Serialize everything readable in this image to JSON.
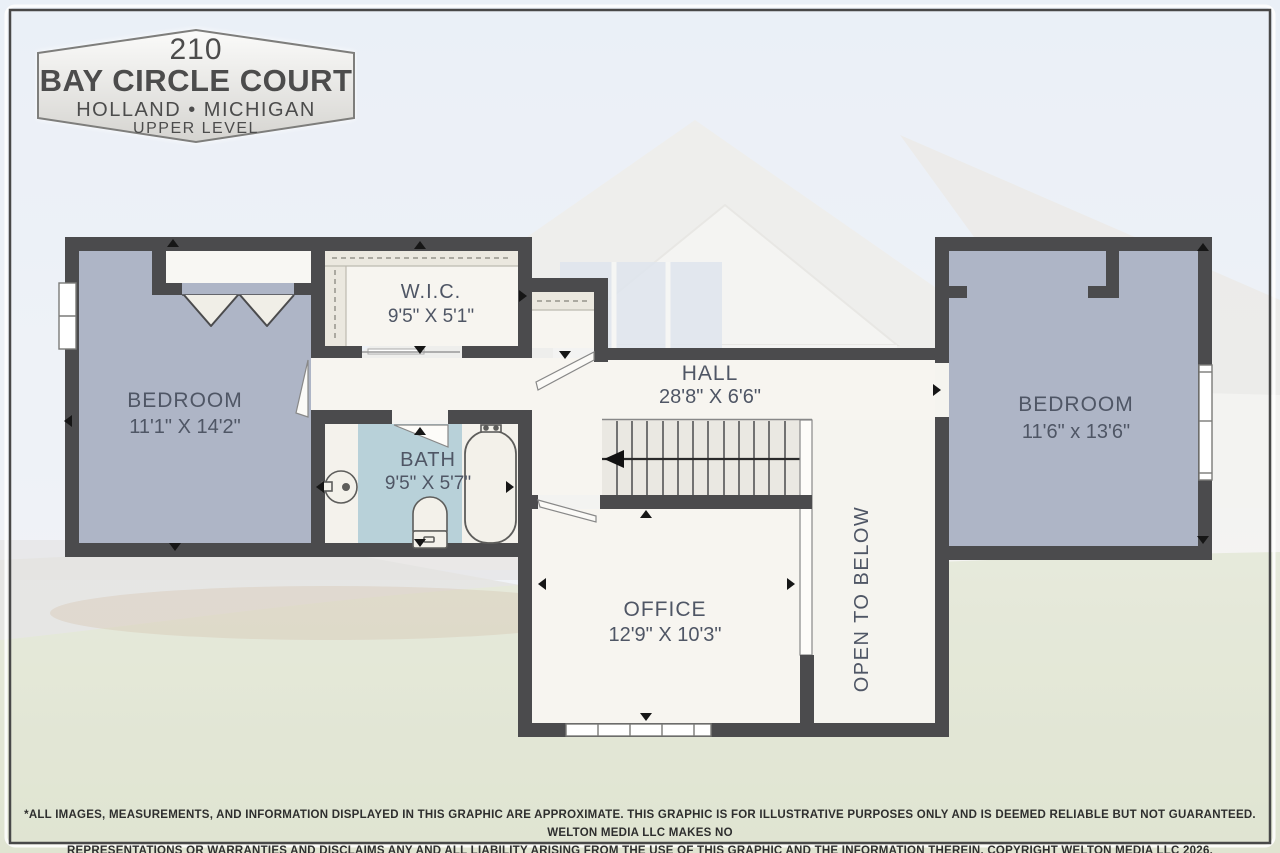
{
  "badge": {
    "address_number": "210",
    "street": "BAY CIRCLE COURT",
    "city_state": "HOLLAND • MICHIGAN",
    "level": "UPPER LEVEL"
  },
  "rooms": {
    "bedroom_left": {
      "name": "BEDROOM",
      "dims": "11'1\" X 14'2\""
    },
    "wic": {
      "name": "W.I.C.",
      "dims": "9'5\" X 5'1\""
    },
    "hall": {
      "name": "HALL",
      "dims": "28'8\" X 6'6\""
    },
    "bath": {
      "name": "BATH",
      "dims": "9'5\" X 5'7\""
    },
    "bedroom_right": {
      "name": "BEDROOM",
      "dims": "11'6\" x 13'6\""
    },
    "office": {
      "name": "OFFICE",
      "dims": "12'9\" X 10'3\""
    },
    "open_to_below": {
      "name": "OPEN TO BELOW"
    }
  },
  "disclaimer": {
    "line1": "*ALL IMAGES, MEASUREMENTS, AND INFORMATION DISPLAYED IN THIS GRAPHIC ARE APPROXIMATE. THIS GRAPHIC IS FOR ILLUSTRATIVE PURPOSES ONLY AND IS DEEMED RELIABLE BUT NOT GUARANTEED. WELTON MEDIA LLC MAKES NO",
    "line2": "REPRESENTATIONS OR WARRANTIES AND DISCLAIMS ANY AND ALL LIABILITY ARISING FROM THE USE OF THIS GRAPHIC AND THE INFORMATION THEREIN. COPYRIGHT WELTON MEDIA LLC 2026."
  },
  "colors": {
    "wall": "#4b4b4d",
    "bedroom_fill": "#aeb5c6",
    "bath_fill": "#b8d1d9",
    "floor_fill": "#f7f5f0",
    "shelf_fill": "#ebe8df",
    "sky": "#e0e8f3",
    "lawn": "#d4dabf"
  }
}
